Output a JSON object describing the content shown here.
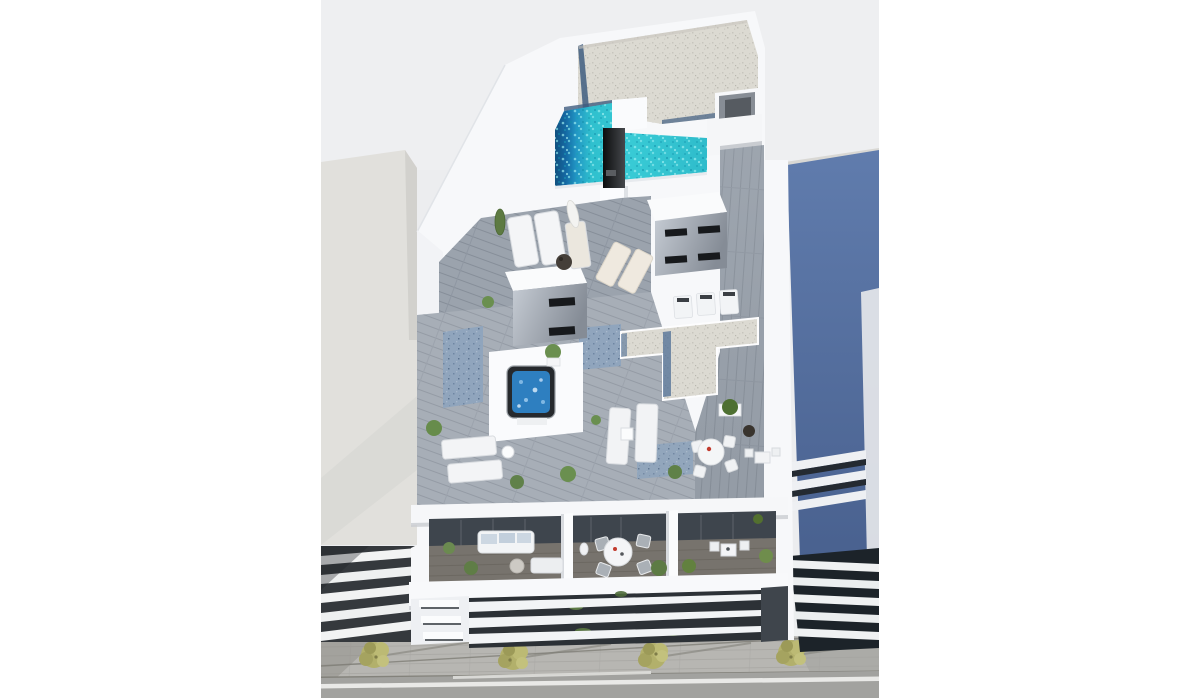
{
  "page": {
    "title": "Aerial 3D architectural render of a new-build apartment block",
    "background": "#ffffff"
  },
  "render": {
    "left": 321,
    "top": 0,
    "width": 558,
    "height": 698,
    "type": "architectural-3d-visualization",
    "description": "Top-down aerial render of a modern white apartment building rooftop solarium with an L-shaped turquoise pool, timber sun decks, outdoor shower column, stair bulkheads, hot tub, sun loungers, dining sets and potted plants; penthouse balconies with outdoor furniture below; white louvre facade; street with four trees; beige neighbouring building on the left and blue neighbouring building on the right.",
    "palette": {
      "backdrop": "#ecedef",
      "building_white": "#f7f8fa",
      "gravel_roof": "#dcdad2",
      "pool_turquoise": "#36c8d4",
      "pool_deep_blue": "#14649f",
      "wood_deck": "#9ba3ad",
      "blue_gravel": "#90a5bd",
      "spa_water": "#2e7fc0",
      "beige_building": "#e1e0dc",
      "blue_building": "#5672a3",
      "dark_glass": "#3e454d",
      "sidewalk": "#b7b6b2",
      "road": "#a2a29f",
      "street_tree": "#b2b06b",
      "dark_slats": "#2c3136",
      "accent_red": "#c23b2e",
      "plant_green": "#5d7a45"
    },
    "objects": {
      "rooftop": [
        "gravel flat roof",
        "L-shaped swimming pool",
        "outdoor shower column",
        "pool stairs",
        "timber deck corridor",
        "stair bulkhead with louvre windows (x2)",
        "hot tub jacuzzi",
        "sun loungers (x8)",
        "closed parasol",
        "round dining table with four chairs",
        "bistro table",
        "boxwood planter",
        "potted plants",
        "cypress tree",
        "rooftop units"
      ],
      "balconies": [
        "sofa with pale blue cushions",
        "round coffee table",
        "day bed",
        "round dining table with four chairs",
        "decorative white vase",
        "bistro table with two chairs",
        "corner planted pots"
      ],
      "facade": [
        "three white louvre bands",
        "three slit windows",
        "climbing greenery in louvre gaps"
      ],
      "street": [
        "paved sidewalk",
        "four street trees",
        "cable shadow line",
        "asphalt road with white markings"
      ]
    },
    "counts": {
      "street_trees": 4,
      "rooftop_loungers": 8,
      "balconies": 3,
      "facade_louvre_bands": 3
    }
  }
}
